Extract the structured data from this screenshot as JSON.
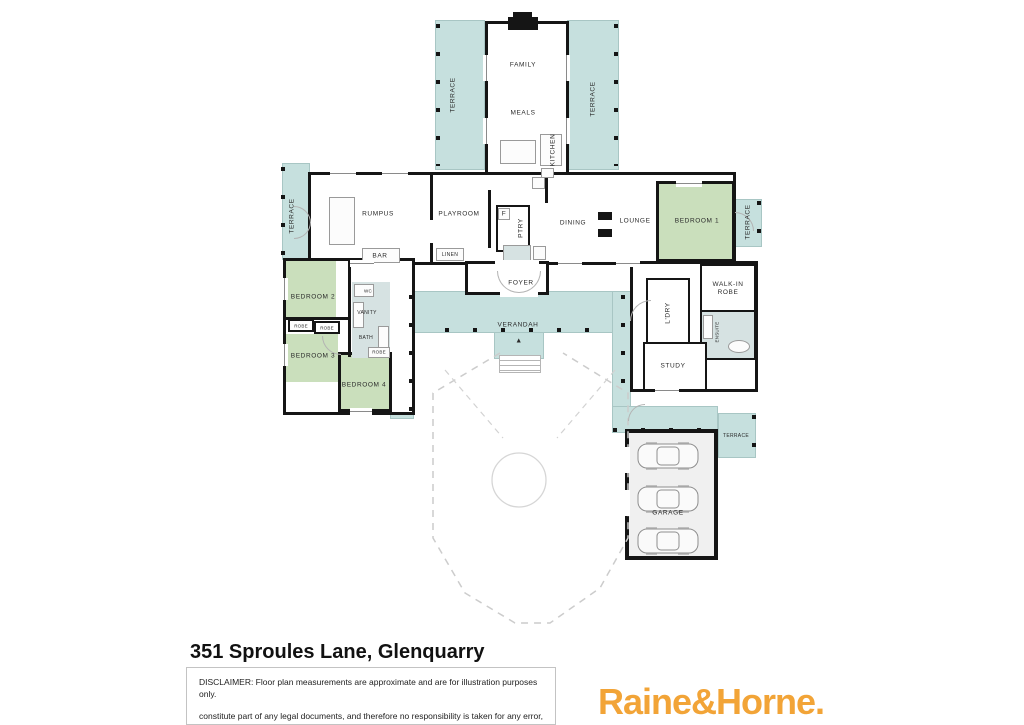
{
  "colors": {
    "terrace": "#c6e0de",
    "bedroom_green": "#cadfbc",
    "wall": "#151515",
    "garage_fill": "#f0f0f0",
    "ensuite_fill": "#d6e2e2",
    "logo_orange": "#F2A437"
  },
  "labels": {
    "terrace": "TERRACE",
    "family": "FAMILY",
    "meals": "MEALS",
    "kitchen": "KITCHEN",
    "rumpus": "RUMPUS",
    "playroom": "PLAYROOM",
    "bar": "BAR",
    "linen": "LINEN",
    "fridge": "F",
    "pantry": "PTRY",
    "dining": "DINING",
    "lounge": "LOUNGE",
    "bedroom1": "BEDROOM 1",
    "bedroom2": "BEDROOM 2",
    "bedroom3": "BEDROOM 3",
    "bedroom4": "BEDROOM 4",
    "robe": "ROBE",
    "wc": "WC",
    "vanity": "VANITY",
    "bath": "BATH",
    "foyer": "FOYER",
    "verandah": "VERANDAH",
    "laundry": "L'DRY",
    "walk_in_robe": "WALK-IN ROBE",
    "ensuite": "ENSUITE",
    "study": "STUDY",
    "garage": "GARAGE"
  },
  "footer": {
    "title": "351 Sproules Lane, Glenquarry",
    "disclaimer_line1": "DISCLAIMER: Floor plan measurements are approximate and are for illustration purposes only.",
    "disclaimer_line2": "constitute part of any legal documents, and therefore no responsibility is taken for any error, omission, or misstatement. This plan is for illustrative purposes only and should only be used as such by any prospective purchaser.",
    "brand": "Raine&Horne."
  }
}
